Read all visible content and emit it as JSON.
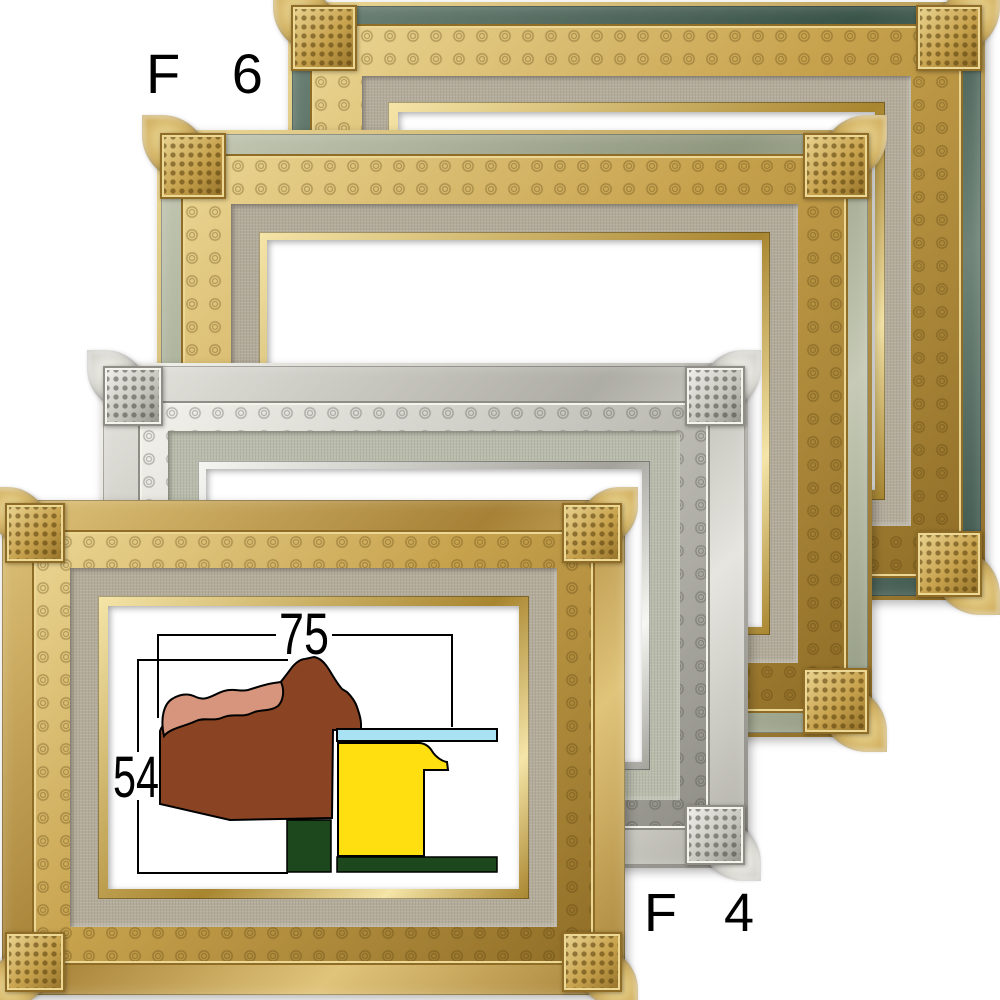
{
  "page": {
    "background": "#ffffff",
    "description_labels": [
      "F 6",
      "F 4"
    ]
  },
  "labels": {
    "size_top": "F 6",
    "size_bottom": "F 4"
  },
  "diagram": {
    "width_mm": "75",
    "height_mm": "54",
    "colors": {
      "line": "#000000",
      "moulding_brown": "#8b4423",
      "moulding_highlight": "#d6957c",
      "canvas_yellow": "#ffdf10",
      "glass_blue": "#a9e2f3",
      "wedge_green": "#1d471d"
    }
  },
  "frames": [
    {
      "name": "frame-gold-green-cap",
      "x": 288,
      "y": 2,
      "w": 697,
      "h": 598,
      "z": 1,
      "bands": {
        "fillet": 4,
        "cap": 18,
        "ornate": 52,
        "linen": 26,
        "lip": 10
      },
      "colors": {
        "cap1": "#6f8377",
        "cap2": "#3a544a",
        "m1": "#ecd795",
        "m2": "#c7a24d",
        "m3": "#8f6d26",
        "ring": "rgba(84,58,8,0.40)",
        "dot": "rgba(84,58,8,0.55)",
        "linen": "#b4ac9b",
        "lip1": "#f5e5a8",
        "lip2": "#a8852f"
      }
    },
    {
      "name": "frame-gold-gray-cap",
      "x": 157,
      "y": 130,
      "w": 715,
      "h": 607,
      "z": 2,
      "bands": {
        "fillet": 4,
        "cap": 20,
        "ornate": 50,
        "linen": 28,
        "lip": 8
      },
      "colors": {
        "cap1": "#c6cab6",
        "cap2": "#8f977e",
        "m1": "#ecd795",
        "m2": "#c7a24d",
        "m3": "#8f6d26",
        "ring": "rgba(84,58,8,0.40)",
        "dot": "rgba(84,58,8,0.55)",
        "linen": "#b2ab9a",
        "lip1": "#f5e5a8",
        "lip2": "#a8852f"
      }
    },
    {
      "name": "frame-silver",
      "x": 100,
      "y": 363,
      "w": 648,
      "h": 505,
      "z": 3,
      "bands": {
        "fillet": 3,
        "cap": 35,
        "ornate": 30,
        "linen": 30,
        "lip": 8
      },
      "colors": {
        "cap1": "#e6e5df",
        "cap2": "#aeada5",
        "m1": "#f4f3ed",
        "m2": "#c7c6bf",
        "m3": "#8f8e86",
        "ring": "rgba(60,60,55,0.38)",
        "dot": "rgba(60,60,55,0.5)",
        "linen": "#b9bcab",
        "lip1": "#f6f6f2",
        "lip2": "#a3a29b"
      }
    },
    {
      "name": "frame-gold-linen-liner",
      "x": 2,
      "y": 500,
      "w": 623,
      "h": 495,
      "z": 4,
      "bands": {
        "fillet": 0,
        "cap": 30,
        "ornate": 38,
        "linen": 28,
        "lip": 10
      },
      "colors": {
        "cap1": "#e0c47a",
        "cap2": "#a68136",
        "m1": "#ecd795",
        "m2": "#c7a24d",
        "m3": "#8f6d26",
        "ring": "rgba(84,58,8,0.40)",
        "dot": "rgba(84,58,8,0.55)",
        "linen": "#b4ac9a",
        "lip1": "#f5e5a8",
        "lip2": "#a8852f"
      }
    }
  ]
}
